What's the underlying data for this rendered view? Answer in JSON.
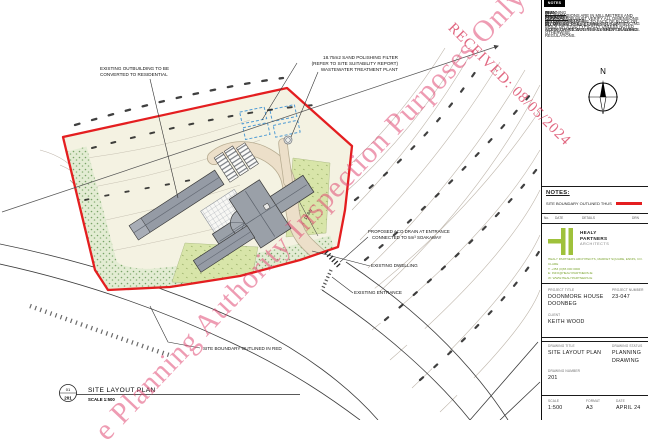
{
  "watermarks": {
    "received": "RECEIVED: 08/05/2024",
    "inspection": "e Planning Authority Inspection Purposes Only"
  },
  "plan": {
    "labels": {
      "outbuilding_1": "EXISTING OUTBUILDING TO BE",
      "outbuilding_2": "CONVERTED TO RESIDENTIAL",
      "filter_1": "18.75m2 SAND POLISHING FILTER",
      "filter_2": "(REFER TO SITE SUITABILITY REPORT)",
      "filter_3": "WASTEWATER TREATMENT PLANT",
      "aco_1": "PROPOSED ACO DRAIN AT ENTRANCE",
      "aco_2": "CONNECTED TO 5m³ SOAKAWAY",
      "dwelling": "EXISTING DWELLING",
      "entrance": "EXISTING ENTRANCE",
      "boundary": "SITE BOUNDARY OUTLINED IN RED",
      "dim_19_8": "19.8m"
    },
    "title_bubble": {
      "top": "01",
      "bottom": "201"
    },
    "title": "SITE LAYOUT PLAN",
    "scale_note": "SCALE 1:500"
  },
  "notes_panel": {
    "tag": "NOTES",
    "compass_label": "N",
    "items": [
      {
        "key": "A.",
        "pre": "THIS DRAWING IS FOR ",
        "underlined": "PLANNING PURPOSES",
        "post": " ONLY."
      },
      {
        "key": "B.",
        "text": "ALL DIMENSIONS ARE IN MILLIMETRES AND LEVELS IN METRES."
      },
      {
        "key": "C.",
        "text": "CONTRACTOR MUST VERIFY ALL DIMENSIONS ON SITE BEFORE SETTING OUT, COMMENCING WORK, OR PRODUCING ANY SHOP DRAWINGS."
      },
      {
        "key": "D.",
        "text": "ALL DIMENSIONS ARE TO FACE OF BLOCK OR BRICK OR STUD TYPICALLY UNLESS NOTED OTHERWISE."
      },
      {
        "key": "E.",
        "text": "ALL WORKS TO BE CARRIED OUT IN ACCORDANCE WITH THE CURRENT BUILDING REGULATIONS."
      }
    ]
  },
  "legend": {
    "heading": "NOTES:",
    "boundary_note": "SITE BOUNDARY OUTLINED THUS"
  },
  "revision_strip": {
    "col_no": "No.",
    "col_date": "DATE",
    "col_details": "DETAILS",
    "col_drn": "DRN"
  },
  "firm": {
    "name_1": "HEALY",
    "name_2": "PARTNERS",
    "name_3": "ARCHITECTS",
    "address_1": "HEALY PARTNERS ARCHITECTS, MARKET SQUARE, ENNIS, CO. CLARE",
    "address_2": "T: +353 (0)65 000 0000",
    "address_3": "E: INFO@HEALYPARTNERS.IE",
    "address_4": "W: WWW.HEALYPARTNERS.IE"
  },
  "title_block": {
    "project_title_label": "PROJECT TITLE",
    "project_title_1": "DOONMORE HOUSE",
    "project_title_2": "DOONBEG",
    "project_number_label": "PROJECT NUMBER",
    "project_number": "23-047",
    "client_label": "CLIENT",
    "client": "KEITH WOOD",
    "drawing_title_label": "DRAWING TITLE",
    "drawing_title": "SITE LAYOUT PLAN",
    "drawing_status_label": "DRAWING STATUS",
    "drawing_status_1": "PLANNING",
    "drawing_status_2": "DRAWING",
    "drawing_number_label": "DRAWING NUMBER",
    "drawing_number": "201",
    "scale_label": "SCALE",
    "scale": "1:500",
    "format_label": "FORMAT",
    "format": "A3",
    "date_label": "DATE",
    "date": "APRIL 24"
  },
  "colors": {
    "boundary_red": "#e41e20",
    "watermark_pink": "#e0436e",
    "logo_green": "#9fc13b"
  }
}
